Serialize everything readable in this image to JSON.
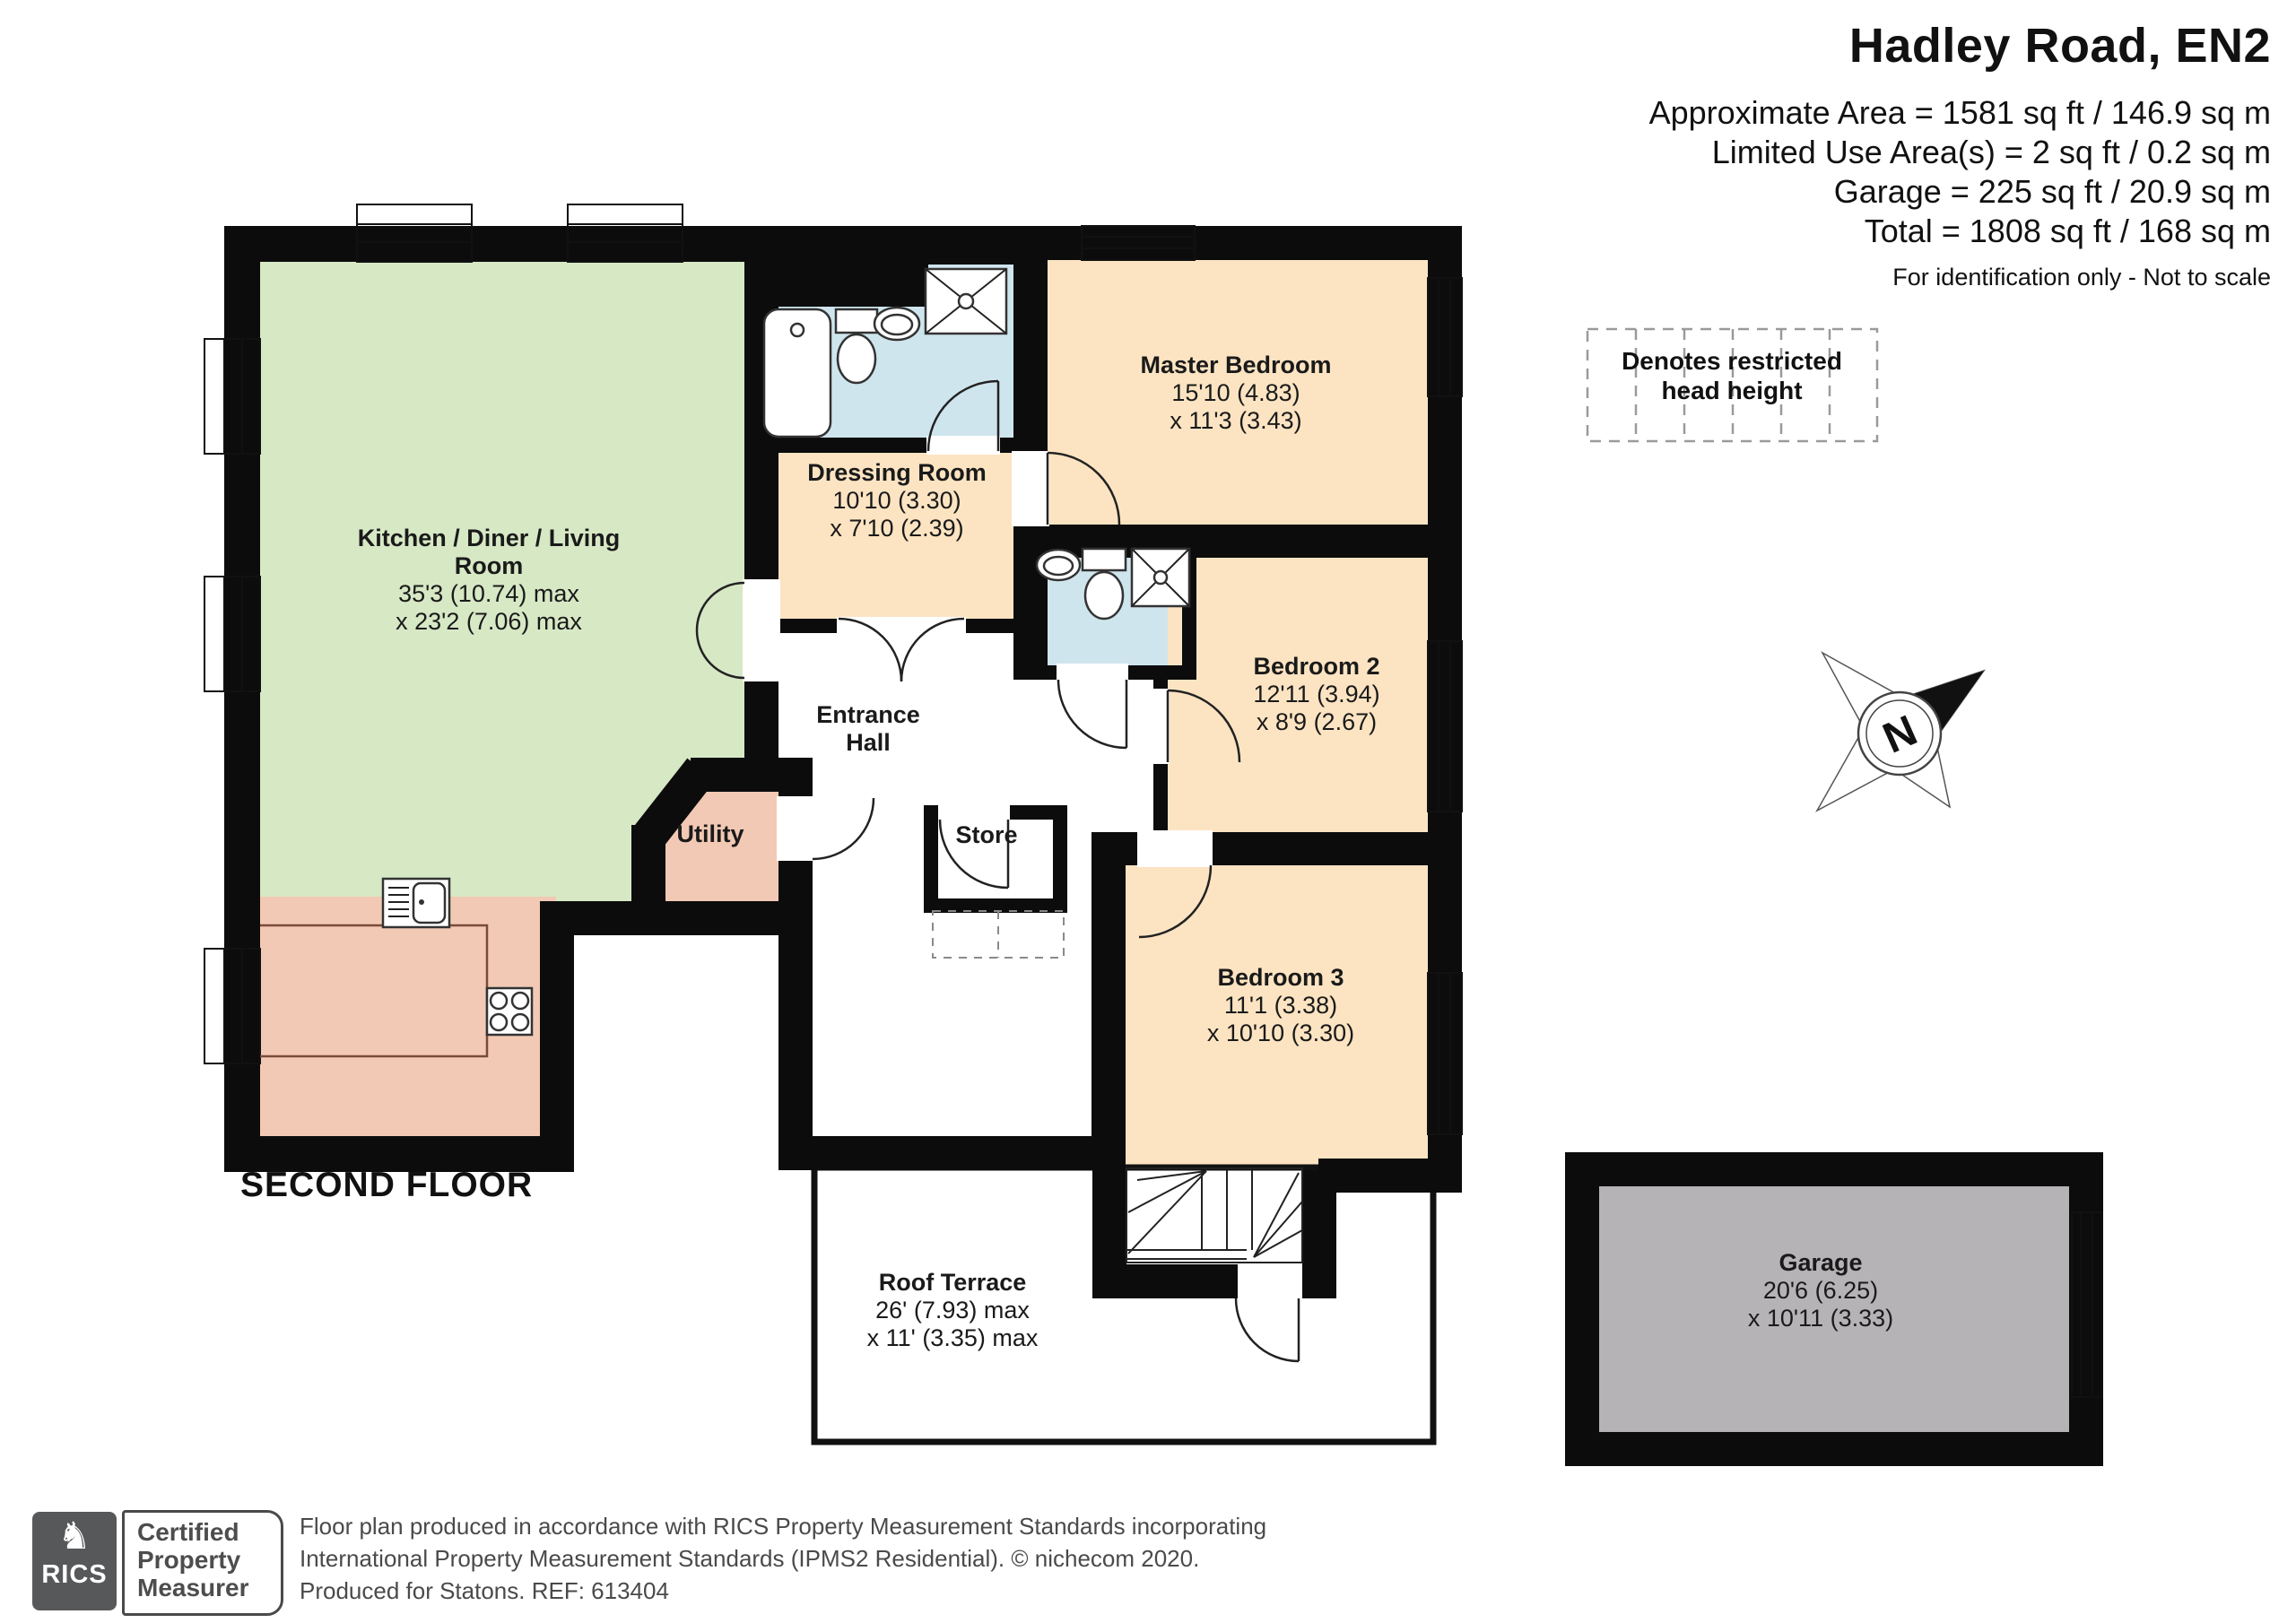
{
  "header": {
    "title": "Hadley Road, EN2",
    "line1": "Approximate Area = 1581 sq ft / 146.9 sq m",
    "line2": "Limited Use Area(s) = 2 sq ft / 0.2 sq m",
    "line3": "Garage = 225 sq ft / 20.9 sq m",
    "line4": "Total = 1808 sq ft / 168 sq m",
    "note": "For identification only - Not to scale"
  },
  "legend": {
    "text": "Denotes restricted head height"
  },
  "compass": {
    "label": "N"
  },
  "floor_label": "SECOND FLOOR",
  "rooms": {
    "kitchen": {
      "name": "Kitchen / Diner / Living Room",
      "dim1": "35'3 (10.74) max",
      "dim2": "x 23'2 (7.06) max"
    },
    "dressing": {
      "name": "Dressing Room",
      "dim1": "10'10 (3.30)",
      "dim2": "x 7'10 (2.39)"
    },
    "master": {
      "name": "Master Bedroom",
      "dim1": "15'10 (4.83)",
      "dim2": "x 11'3 (3.43)"
    },
    "bedroom2": {
      "name": "Bedroom 2",
      "dim1": "12'11 (3.94)",
      "dim2": "x 8'9 (2.67)"
    },
    "bedroom3": {
      "name": "Bedroom 3",
      "dim1": "11'1 (3.38)",
      "dim2": "x 10'10 (3.30)"
    },
    "entrance": {
      "name": "Entrance Hall"
    },
    "utility": {
      "name": "Utility"
    },
    "store": {
      "name": "Store"
    },
    "terrace": {
      "name": "Roof Terrace",
      "dim1": "26' (7.93) max",
      "dim2": "x 11' (3.35) max"
    },
    "garage": {
      "name": "Garage",
      "dim1": "20'6 (6.25)",
      "dim2": "x 10'11 (3.33)"
    }
  },
  "footer": {
    "rics_label": "RICS",
    "certified": "Certified Property Measurer",
    "line1": "Floor plan produced in accordance with RICS Property Measurement Standards incorporating",
    "line2": "International Property Measurement Standards (IPMS2 Residential).  © nichecom 2020.",
    "line3": "Produced for Statons.   REF: 613404"
  },
  "colors": {
    "living": "#d7e8c5",
    "salmon": "#f2c9b4",
    "blue": "#cfe5ed",
    "cream": "#fce4c2",
    "garage": "#b6b3b6",
    "wall": "#0c0c0c"
  }
}
